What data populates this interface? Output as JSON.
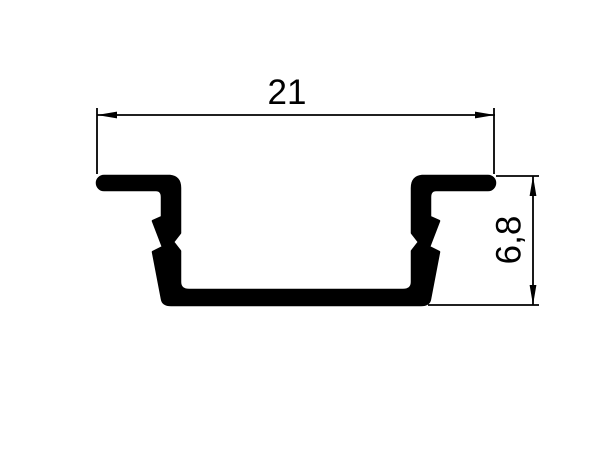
{
  "canvas": {
    "background": "#ffffff",
    "line_color": "#000000"
  },
  "drawing": {
    "subject": "recessed-channel-profile-cross-section",
    "dimensions": [
      {
        "id": "width",
        "text": "21",
        "value": 21,
        "orientation": "horizontal"
      },
      {
        "id": "height",
        "text": "6,8",
        "value": 6.8,
        "orientation": "vertical"
      }
    ],
    "profile_path": "M 104 176 L 170 176 Q 180 177 180 188 L 180 233 L 173 242 L 180 251 L 180 282 Q 180 290 189 290 L 403 290 Q 412 290 412 282 L 412 251 L 419 242 L 412 233 L 412 188 Q 412 177 422 176 L 488 176 A 7 7 0 0 1 495 183 A 7 7 0 0 1 488 190 L 436 190 Q 430 190 430 197 L 430 217 L 439 221 L 429 247 L 439 252 L 430 299 Q 429 305 421 305 L 171 305 Q 163 305 162 299 L 153 252 L 163 247 L 153 221 L 162 217 L 162 197 Q 162 190 156 190 L 104 190 A 7 7 0 0 1 97 183 A 7 7 0 0 1 104 176 Z"
  }
}
